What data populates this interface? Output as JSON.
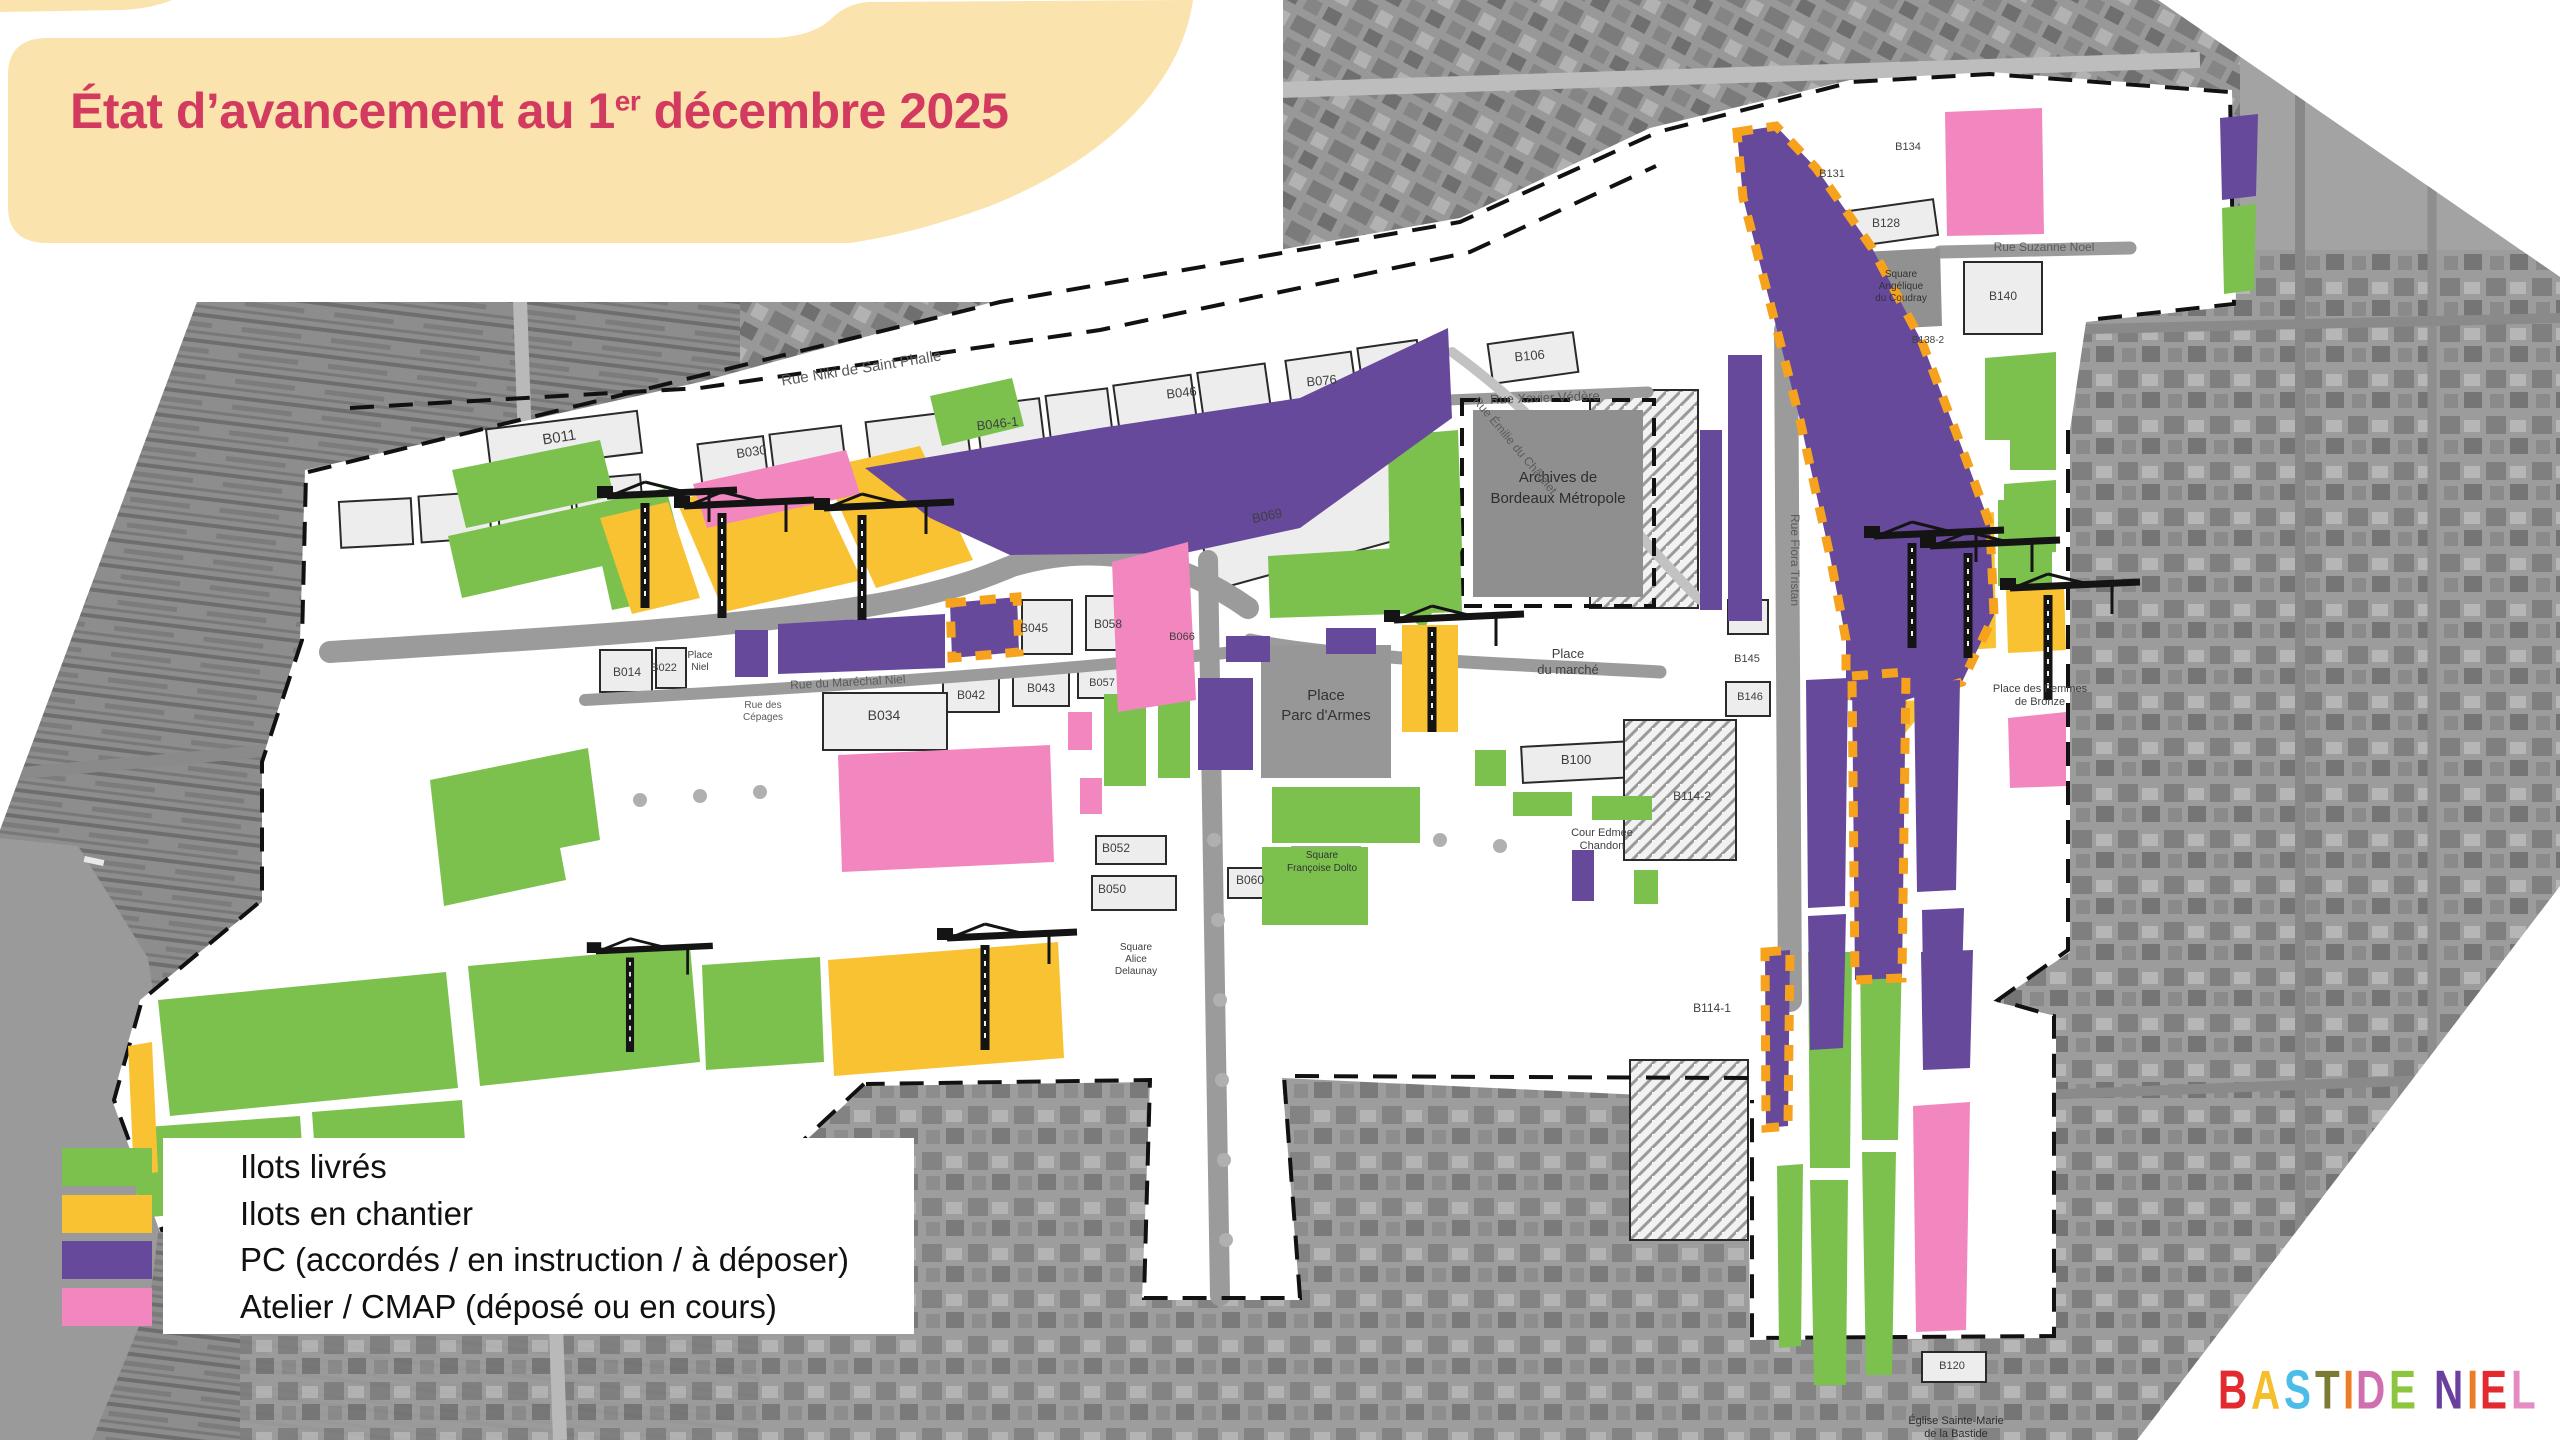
{
  "title": {
    "main": "État d’avancement au 1",
    "sup": "er",
    "rest": " décembre 2025",
    "color": "#D23A5F"
  },
  "legend": {
    "items": [
      {
        "key": "green",
        "label": "Ilots livrés",
        "color": "#7CC14E"
      },
      {
        "key": "orange",
        "label": "Ilots en chantier",
        "color": "#F9C233"
      },
      {
        "key": "purple",
        "label": "PC (accordés / en instruction / à déposer)",
        "color": "#67499C"
      },
      {
        "key": "pink",
        "label": "Atelier / CMAP (déposé ou en cours)",
        "color": "#F287BF"
      }
    ]
  },
  "logo": {
    "letters": [
      {
        "ch": "B",
        "color": "#E22A2F"
      },
      {
        "ch": "A",
        "color": "#F5BE2D"
      },
      {
        "ch": "S",
        "color": "#4BBDE8"
      },
      {
        "ch": "T",
        "color": "#7C7B35"
      },
      {
        "ch": "I",
        "color": "#EC7D26"
      },
      {
        "ch": "D",
        "color": "#CF6FB0"
      },
      {
        "ch": "E",
        "color": "#8CC63F"
      },
      {
        "ch": " ",
        "color": "#000000"
      },
      {
        "ch": "N",
        "color": "#6A3F9E"
      },
      {
        "ch": "I",
        "color": "#EC7D26"
      },
      {
        "ch": "E",
        "color": "#E22A2F"
      },
      {
        "ch": "L",
        "color": "#E58BC1"
      }
    ]
  },
  "colors": {
    "green": "#7CC14E",
    "orange": "#F9C233",
    "purple": "#67499C",
    "pink": "#F287BF",
    "cream": "#FAE3AC",
    "title_red": "#D23A5F",
    "dash_orange": "#F6A21D",
    "plan_white": "#FFFFFF",
    "plot_fill": "#EDEDED",
    "plot_stroke": "#2A2A2A",
    "road_gray": "#9B9B9B",
    "dark_block": "#8F8F8F",
    "photo_base": "#A3A3A3"
  },
  "map_labels": [
    {
      "t": "Rue Niki de Saint Phalle",
      "x": 862,
      "y": 373,
      "s": 15,
      "r": -9,
      "c": "#5a5a5a"
    },
    {
      "t": "B030",
      "x": 752,
      "y": 456,
      "s": 13,
      "r": -8
    },
    {
      "t": "B011",
      "x": 560,
      "y": 442,
      "s": 15,
      "r": -9
    },
    {
      "t": "B046-1",
      "x": 998,
      "y": 428,
      "s": 13,
      "r": -7
    },
    {
      "t": "B046",
      "x": 1182,
      "y": 397,
      "s": 13,
      "r": -6
    },
    {
      "t": "B076",
      "x": 1322,
      "y": 385,
      "s": 13,
      "r": -5
    },
    {
      "t": "B106",
      "x": 1530,
      "y": 360,
      "s": 13,
      "r": -5
    },
    {
      "t": "Rue Xavier Védère",
      "x": 1545,
      "y": 402,
      "s": 13,
      "r": -2,
      "c": "#5a5a5a"
    },
    {
      "t": "Archives de",
      "x": 1558,
      "y": 482,
      "s": 15,
      "c": "#2e2e2e"
    },
    {
      "t": "Bordeaux Métropole",
      "x": 1558,
      "y": 503,
      "s": 15,
      "c": "#2e2e2e"
    },
    {
      "t": "Rue Émilie du Châtelet",
      "x": 1512,
      "y": 448,
      "s": 12,
      "r": 50,
      "c": "#5a5a5a"
    },
    {
      "t": "B069",
      "x": 1268,
      "y": 520,
      "s": 13,
      "r": -12
    },
    {
      "t": "B045",
      "x": 1034,
      "y": 632,
      "s": 12
    },
    {
      "t": "B058",
      "x": 1108,
      "y": 628,
      "s": 12
    },
    {
      "t": "B014",
      "x": 627,
      "y": 676,
      "s": 12
    },
    {
      "t": "B022",
      "x": 664,
      "y": 671,
      "s": 11
    },
    {
      "t": "Place",
      "x": 700,
      "y": 658,
      "s": 10
    },
    {
      "t": "Niel",
      "x": 700,
      "y": 670,
      "s": 10
    },
    {
      "t": "Rue du Maréchal Niel",
      "x": 848,
      "y": 686,
      "s": 12,
      "r": -3,
      "c": "#5a5a5a"
    },
    {
      "t": "B034",
      "x": 884,
      "y": 720,
      "s": 14
    },
    {
      "t": "B042",
      "x": 971,
      "y": 699,
      "s": 12
    },
    {
      "t": "B043",
      "x": 1041,
      "y": 692,
      "s": 12
    },
    {
      "t": "B057",
      "x": 1102,
      "y": 686,
      "s": 11
    },
    {
      "t": "B066",
      "x": 1182,
      "y": 640,
      "s": 11
    },
    {
      "t": "Rue des",
      "x": 763,
      "y": 708,
      "s": 10,
      "c": "#5a5a5a"
    },
    {
      "t": "Cépages",
      "x": 763,
      "y": 720,
      "s": 10,
      "c": "#5a5a5a"
    },
    {
      "t": "Place",
      "x": 1326,
      "y": 700,
      "s": 15,
      "c": "#333333"
    },
    {
      "t": "Parc d'Armes",
      "x": 1326,
      "y": 720,
      "s": 15,
      "c": "#333333"
    },
    {
      "t": "Place",
      "x": 1568,
      "y": 658,
      "s": 13
    },
    {
      "t": "du marché",
      "x": 1568,
      "y": 674,
      "s": 13
    },
    {
      "t": "B100",
      "x": 1576,
      "y": 764,
      "s": 13
    },
    {
      "t": "Cour Edmée",
      "x": 1602,
      "y": 836,
      "s": 11
    },
    {
      "t": "Chandon",
      "x": 1602,
      "y": 849,
      "s": 11
    },
    {
      "t": "B052",
      "x": 1116,
      "y": 852,
      "s": 12
    },
    {
      "t": "B050",
      "x": 1112,
      "y": 893,
      "s": 12
    },
    {
      "t": "B060",
      "x": 1250,
      "y": 884,
      "s": 12
    },
    {
      "t": "Square",
      "x": 1322,
      "y": 858,
      "s": 10,
      "c": "#333333"
    },
    {
      "t": "Françoise Dolto",
      "x": 1322,
      "y": 871,
      "s": 10,
      "c": "#333333"
    },
    {
      "t": "Square",
      "x": 1136,
      "y": 950,
      "s": 10
    },
    {
      "t": "Alice",
      "x": 1136,
      "y": 962,
      "s": 10
    },
    {
      "t": "Delaunay",
      "x": 1136,
      "y": 974,
      "s": 10
    },
    {
      "t": "Passage de la Vinaigrerie",
      "x": 330,
      "y": 1182,
      "s": 15,
      "r": -4,
      "c": "#4a4a4a"
    },
    {
      "t": "B145",
      "x": 1747,
      "y": 662,
      "s": 11
    },
    {
      "t": "B146",
      "x": 1750,
      "y": 700,
      "s": 11
    },
    {
      "t": "B114-2",
      "x": 1692,
      "y": 800,
      "s": 12
    },
    {
      "t": "B114-1",
      "x": 1712,
      "y": 1012,
      "s": 12
    },
    {
      "t": "Rue Flora Tristan",
      "x": 1791,
      "y": 560,
      "s": 12,
      "r": 90,
      "c": "#5a5a5a"
    },
    {
      "t": "B128",
      "x": 1886,
      "y": 227,
      "s": 12
    },
    {
      "t": "B131",
      "x": 1832,
      "y": 177,
      "s": 11
    },
    {
      "t": "B134",
      "x": 1908,
      "y": 150,
      "s": 11
    },
    {
      "t": "Square",
      "x": 1901,
      "y": 277,
      "s": 10,
      "c": "#333333"
    },
    {
      "t": "Angélique",
      "x": 1901,
      "y": 289,
      "s": 10,
      "c": "#333333"
    },
    {
      "t": "du Coudray",
      "x": 1901,
      "y": 301,
      "s": 10,
      "c": "#333333"
    },
    {
      "t": "Rue Suzanne Noel",
      "x": 2044,
      "y": 251,
      "s": 12,
      "c": "#5a5a5a"
    },
    {
      "t": "B140",
      "x": 2003,
      "y": 300,
      "s": 12
    },
    {
      "t": "B138-2",
      "x": 1928,
      "y": 343,
      "s": 10
    },
    {
      "t": "Place des Femmes",
      "x": 2040,
      "y": 692,
      "s": 11
    },
    {
      "t": "de Bronze",
      "x": 2040,
      "y": 705,
      "s": 11
    },
    {
      "t": "B120",
      "x": 1952,
      "y": 1369,
      "s": 11
    },
    {
      "t": "Église Sainte-Marie",
      "x": 1956,
      "y": 1424,
      "s": 11,
      "c": "#2e2e2e"
    },
    {
      "t": "de la Bastide",
      "x": 1956,
      "y": 1437,
      "s": 11,
      "c": "#2e2e2e"
    }
  ]
}
